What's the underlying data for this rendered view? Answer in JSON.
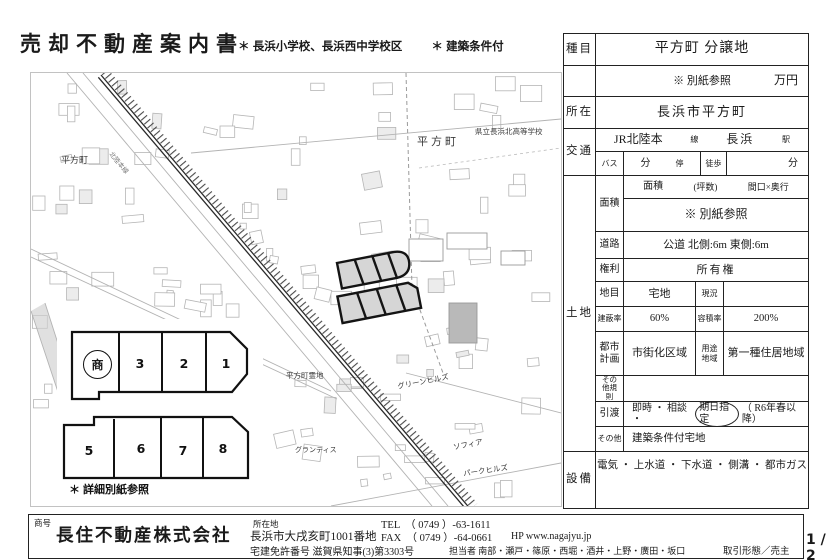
{
  "header": {
    "title": "売却不動産案内書",
    "note_school": "＊ 長浜小学校、長浜西中学校区",
    "note_condition": "＊ 建築条件付"
  },
  "map": {
    "town_left": "平方町",
    "town_right": "平方町",
    "school": "県立長浜北高等学校",
    "rail_line": "北陸本線",
    "cemetery": "平方町霊地",
    "green_hills": "グリーンヒルズ",
    "grantis": "グランティス",
    "sofia": "ソフィア",
    "park_hills": "パークヒルズ"
  },
  "inset": {
    "sho": "商",
    "top": [
      "3",
      "2",
      "1"
    ],
    "bottom": [
      "5",
      "6",
      "7",
      "8"
    ],
    "note": "＊ 詳細別紙参照"
  },
  "table": {
    "shumoku_label": "種目",
    "shumoku": "平方町 分譲地",
    "price_note": "※ 別紙参照",
    "price_unit": "万円",
    "shozai_label": "所在",
    "shozai": "長浜市平方町",
    "kotsu_label": "交通",
    "rail_name": "JR北陸本",
    "rail_suffix": "線",
    "station": "長浜",
    "station_suffix": "駅",
    "bus_label": "バス",
    "bus_min": "分",
    "bus_stop": "停",
    "walk_label": "徒歩",
    "walk_min": "分",
    "tochi_label": "土地",
    "menseki_label": "面積",
    "menseki_h1": "面積",
    "menseki_h2": "(坪数)",
    "menseki_h3": "間口×奥行",
    "menseki_value": "※ 別紙参照",
    "doro_label": "道路",
    "doro": "公道  北側:6m  東側:6m",
    "kenri_label": "権利",
    "kenri": "所有権",
    "chimoku_label": "地目",
    "chimoku": "宅地",
    "genkyo_label": "現況",
    "genkyo": "",
    "kenpei_label": "建蔽率",
    "kenpei": "60%",
    "yoseki_label": "容積率",
    "yoseki": "200%",
    "toshi_label": "都市計画",
    "toshi": "市街化区域",
    "yoto_label": "用途地域",
    "yoto": "第一種住居地域",
    "kisoku_label": "その他規則",
    "kisoku": "",
    "hikiwatashi_label": "引渡",
    "hikiwatashi_pre": "即時 ・ 相談 ・",
    "hikiwatashi_circled": "期日指定",
    "hikiwatashi_post": "（ R6年春以降）",
    "sonota_label": "その他",
    "sonota": "建築条件付宅地",
    "setsubi_label": "設備",
    "setsubi": "電気 ・ 上水道 ・ 下水道 ・ 側溝 ・ 都市ガス"
  },
  "footer": {
    "shogo_label": "商号",
    "company": "長住不動産株式会社",
    "address_label": "所在地",
    "address": "長浜市大戌亥町1001番地",
    "license": "宅建免許番号  滋賀県知事(3)第3303号",
    "tel": "TEL　（ 0749 ）-63-1611",
    "fax": "FAX　（ 0749 ）-64-0661",
    "hp": "HP  www.nagajyu.jp",
    "staff": "担当者  南部・瀬戸・篠原・西堀・酒井・上野・廣田・坂口",
    "transaction": "取引形態／売主",
    "page": "1 / 2"
  }
}
